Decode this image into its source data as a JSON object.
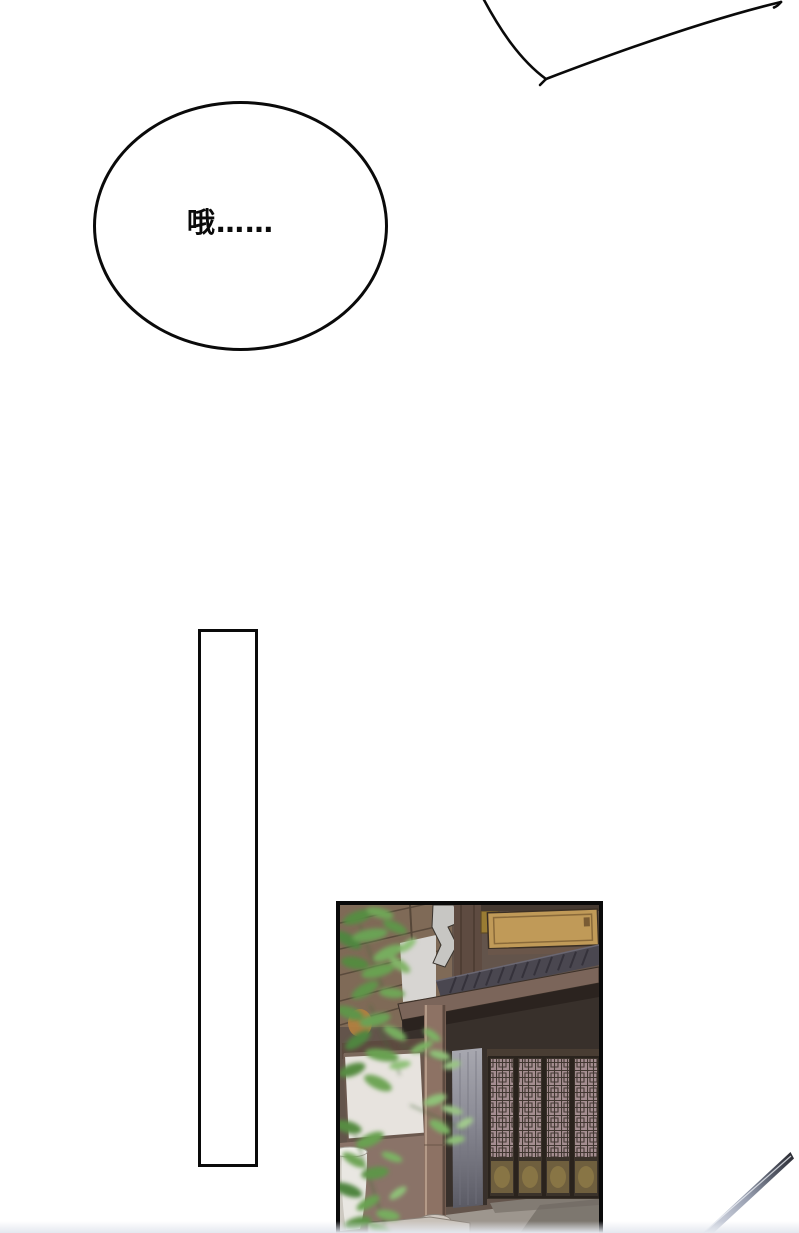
{
  "speech": {
    "oh_bubble": {
      "text": "哦……"
    },
    "partial_bubble": {
      "note": ""
    }
  },
  "panel_scene": {
    "subject": "traditional-chinese-storefront",
    "elements": [
      "tree-foliage",
      "signboard",
      "tiled-roof-eave",
      "lattice-doors",
      "wooden-column",
      "stone-pillar",
      "white-wall-panel",
      "plant-pot",
      "stone-step"
    ]
  },
  "colors": {
    "ink": "#0a0a0a",
    "paper": "#ffffff",
    "foliage": "#6aa054",
    "wood": "#6b564a",
    "sign": "#c09a58",
    "lattice": "#a58e91",
    "door_gold": "#8d7947",
    "stone": "#c8c1b9",
    "blade": "#c9ced9"
  }
}
